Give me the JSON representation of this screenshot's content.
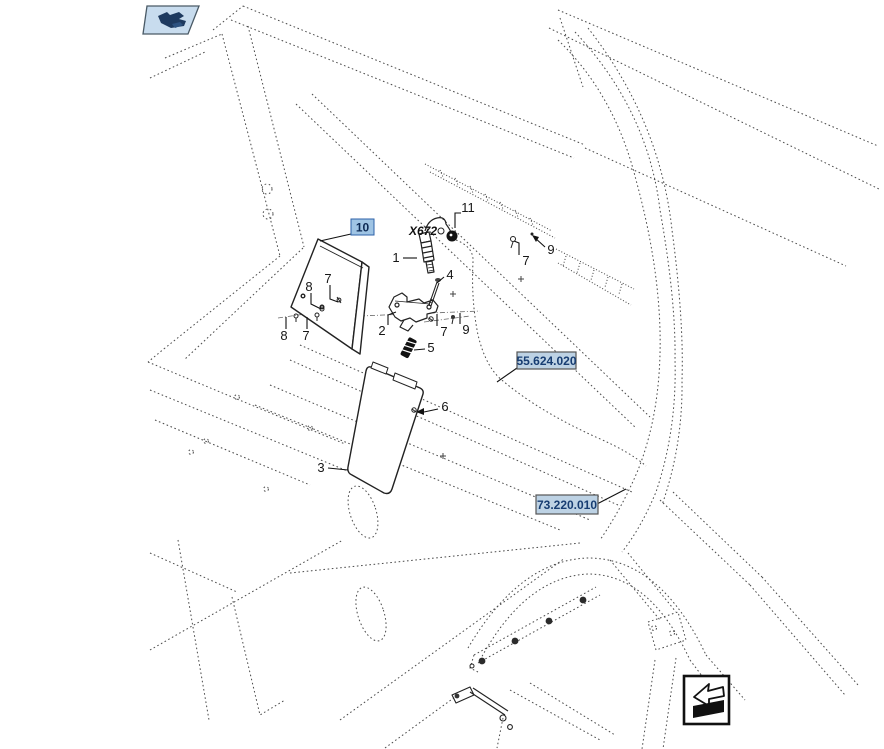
{
  "page": {
    "background": "#ffffff",
    "border_color": "#dcdcdc",
    "line_color": "#4a4a4a",
    "part_line_color": "#222222"
  },
  "nav": {
    "prev_button": {
      "icon": "hand-page-icon",
      "bg": "#c8dcee",
      "border": "#4a5a66",
      "glyph_color": "#1e3a5f"
    },
    "return_button": {
      "icon": "return-arrow-icon",
      "bg": "#ffffff",
      "border": "#111111",
      "glyph_color": "#111111"
    }
  },
  "diagram": {
    "type": "exploded-parts-diagram",
    "connector_label": "X672",
    "highlight_ref": {
      "label": "10",
      "fill": "#9fc4e4",
      "border": "#2d62a8",
      "text_color": "#0d2a55"
    },
    "section_refs": [
      {
        "label": "55.624.020",
        "fill": "#bdd2e4",
        "border": "#555555",
        "text_color": "#173d72"
      },
      {
        "label": "73.220.010",
        "fill": "#bdd2e4",
        "border": "#555555",
        "text_color": "#173d72"
      }
    ],
    "callouts": [
      {
        "label": "1"
      },
      {
        "label": "2"
      },
      {
        "label": "3"
      },
      {
        "label": "4"
      },
      {
        "label": "5"
      },
      {
        "label": "6"
      },
      {
        "label": "7"
      },
      {
        "label": "8"
      },
      {
        "label": "8"
      },
      {
        "label": "7"
      },
      {
        "label": "7"
      },
      {
        "label": "9"
      },
      {
        "label": "7"
      },
      {
        "label": "9"
      },
      {
        "label": "11"
      }
    ]
  }
}
